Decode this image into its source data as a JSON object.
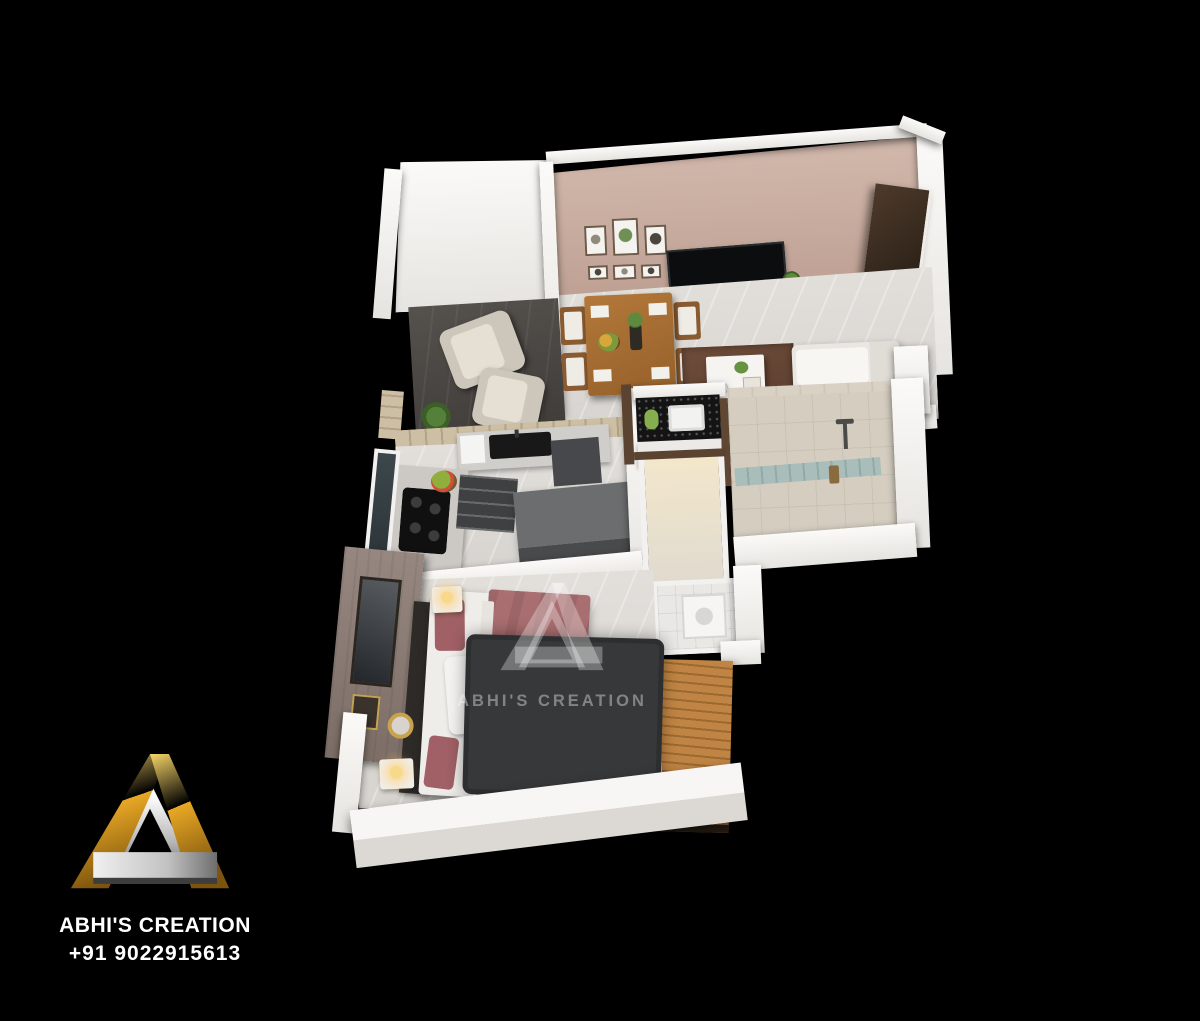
{
  "page": {
    "background_color": "#000000"
  },
  "watermark": {
    "brand": "ABHI'S CREATION"
  },
  "footer": {
    "brand": "ABHI'S CREATION",
    "phone": "+91 9022915613"
  },
  "brand_colors": {
    "gold": "#e9a825",
    "gold_dark": "#7d540e",
    "silver": "#c9c9c9",
    "text_white": "#ffffff"
  },
  "floorplan": {
    "type": "3d-isometric-apartment-render",
    "rooms": [
      {
        "name": "balcony",
        "furniture": [
          "armchair-1",
          "armchair-2",
          "flower-planters",
          "potted-plant"
        ]
      },
      {
        "name": "living-dining-room",
        "furniture": [
          "wall-tv",
          "tv-console",
          "six-picture-frames",
          "dining-table-four-chairs",
          "coffee-table",
          "brown-rug",
          "white-sofa",
          "entrance-wardrobe"
        ]
      },
      {
        "name": "kitchen",
        "furniture": [
          "sink-counter",
          "gas-hob",
          "left-counter",
          "island-cabinet",
          "fruit-bowl",
          "stone-wall"
        ]
      },
      {
        "name": "wash-area",
        "furniture": [
          "granite-counter",
          "wash-basin"
        ]
      },
      {
        "name": "bathroom",
        "furniture": [
          "shower",
          "teal-glass-tiles",
          "door-frame"
        ]
      },
      {
        "name": "corridor",
        "furniture": []
      },
      {
        "name": "toilet",
        "furniture": [
          "shower-tray"
        ]
      },
      {
        "name": "bedroom",
        "furniture": [
          "double-bed-maroon",
          "headboard",
          "bedside-table-1",
          "bedside-table-2",
          "lamps",
          "shag-rug",
          "mirror-wall",
          "round-gold-mirror"
        ]
      },
      {
        "name": "wood-deck",
        "furniture": [
          "wood-decking"
        ]
      }
    ],
    "palette": {
      "accent_wall_mauve": "#c2a295",
      "floor_light": "#dddad6",
      "balcony_floor_dark": "#4b4846",
      "bed_maroon": "#a56a6c",
      "wood_brown": "#b5793c",
      "rug_dark": "#3a3b3d",
      "rug_brown": "#6a4a3a",
      "wall_white": "#f3f2f0",
      "glass_teal": "#9fb8b6"
    }
  }
}
